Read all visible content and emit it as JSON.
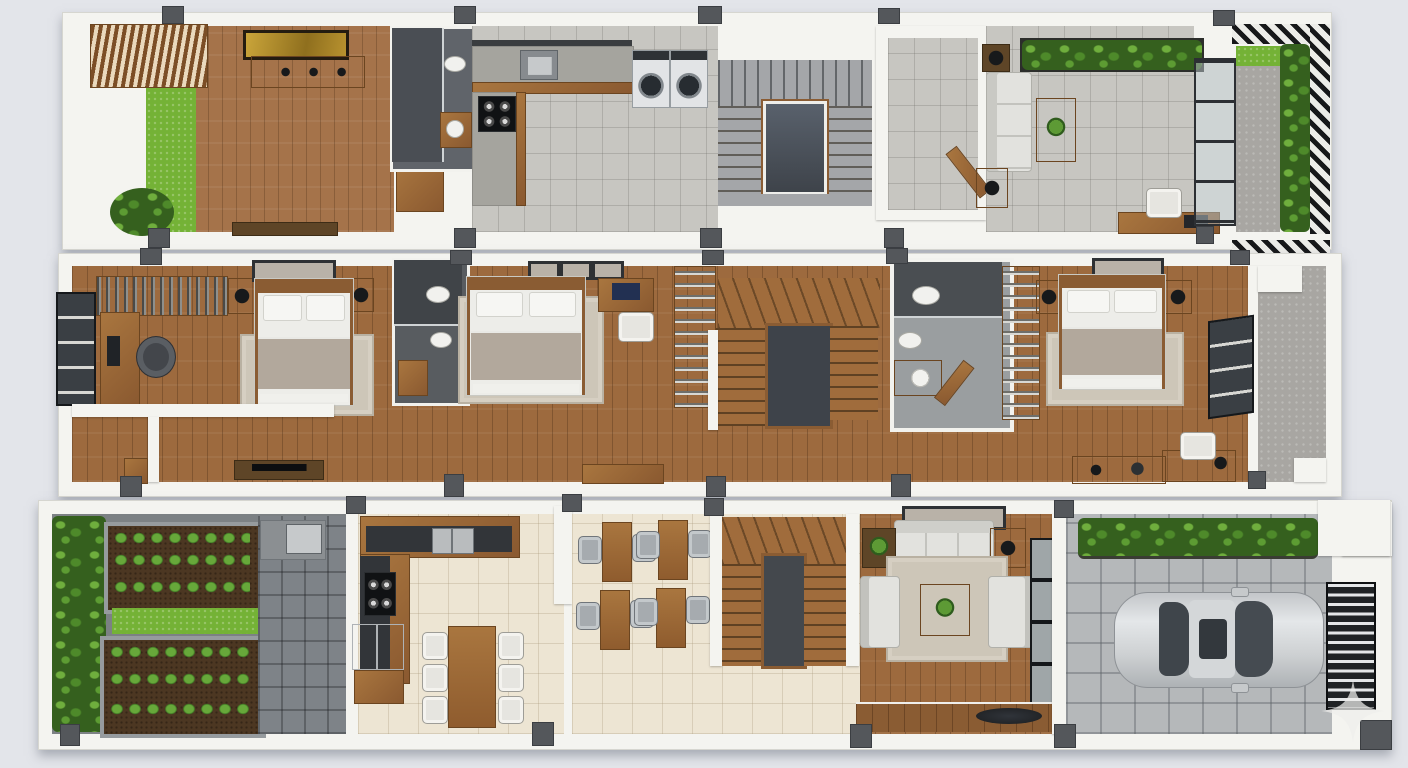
{
  "scene": {
    "title": "Three-storey narrow house floor plan — 3D top-down render",
    "view": "top-down axonometric, three floor strips stacked vertically",
    "floors": [
      {
        "name": "top floor",
        "rooms": [
          {
            "name": "family room",
            "features": [
              "slatted-pergola",
              "grass-strip",
              "potted-plant",
              "gold-wall-art",
              "console-table",
              "media-bench",
              "wood-floor"
            ]
          },
          {
            "name": "bathroom",
            "features": [
              "walk-in-shower",
              "toilet",
              "washbasin",
              "vanity"
            ]
          },
          {
            "name": "kitchen-laundry",
            "features": [
              "l-shaped-counter",
              "sink",
              "cooktop",
              "washer",
              "dryer",
              "grey-tile-floor"
            ]
          },
          {
            "name": "staircase",
            "features": [
              "u-shaped-stair",
              "open-stairwell",
              "railing"
            ]
          },
          {
            "name": "storage-room",
            "features": [
              "open-door"
            ]
          },
          {
            "name": "lounge",
            "features": [
              "sofa",
              "coffee-table",
              "side-tables",
              "planter-boxes",
              "desk",
              "chair",
              "laptop",
              "glass-sliding-doors"
            ]
          },
          {
            "name": "roof-terrace",
            "features": [
              "pergola-grating",
              "hedge",
              "grass",
              "concrete-path"
            ]
          }
        ]
      },
      {
        "name": "middle floor",
        "rooms": [
          {
            "name": "bedroom-1",
            "features": [
              "double-bed",
              "pillows",
              "rug",
              "open-wardrobe",
              "desk",
              "monitor",
              "office-chair",
              "window",
              "wall-art",
              "nightstands"
            ]
          },
          {
            "name": "ensuite-bathroom",
            "features": [
              "shower",
              "toilet",
              "bidet",
              "wood-mat"
            ]
          },
          {
            "name": "bedroom-2",
            "features": [
              "double-bed",
              "rug",
              "desk",
              "laptop",
              "chair",
              "open-shelf-wardrobe",
              "picture-frames"
            ]
          },
          {
            "name": "staircase",
            "features": [
              "wood-stair",
              "open-stairwell"
            ]
          },
          {
            "name": "bathroom-2",
            "features": [
              "shower",
              "toilet",
              "bidet",
              "vanity-sink",
              "door"
            ]
          },
          {
            "name": "wardrobe-shelf",
            "features": [
              "open-shelves"
            ]
          },
          {
            "name": "bedroom-3",
            "features": [
              "double-bed",
              "nightstands",
              "rug",
              "wall-art",
              "desk",
              "chair",
              "window"
            ]
          },
          {
            "name": "balcony",
            "features": [
              "concrete-floor",
              "white-ledges"
            ]
          },
          {
            "name": "hallway",
            "features": [
              "tv-bench",
              "cabinet",
              "dresser",
              "wood-floor"
            ]
          }
        ]
      },
      {
        "name": "ground floor",
        "rooms": [
          {
            "name": "vegetable-garden",
            "features": [
              "shrub-border",
              "raised-bed-a",
              "grass-strip",
              "raised-bed-b",
              "stone-paver-path",
              "outdoor-sink"
            ]
          },
          {
            "name": "kitchen",
            "features": [
              "l-shaped-counter",
              "sink",
              "cooktop",
              "refrigerator",
              "dining-table",
              "six-chairs",
              "beige-tile-floor"
            ]
          },
          {
            "name": "dining-area",
            "features": [
              "four-two-seat-tables",
              "eight-chairs"
            ]
          },
          {
            "name": "staircase",
            "features": [
              "wood-stair",
              "open-stairwell"
            ]
          },
          {
            "name": "living-room",
            "features": [
              "sofa",
              "two-armchairs",
              "coffee-table",
              "plant",
              "rug",
              "side-tables",
              "picture-window",
              "wood-step",
              "decor-bowl"
            ]
          },
          {
            "name": "garage-driveway",
            "features": [
              "hedge-planter",
              "silver-car",
              "slatted-gate",
              "paver-floor",
              "carport-roof"
            ]
          }
        ]
      }
    ]
  },
  "palette": {
    "background": "#e3e5ea",
    "wall_white": "#f4f4f0",
    "wood_floor": "#9d6a3e",
    "grey_tile": "#c7c6c1",
    "beige_tile": "#ede5d3",
    "dark_bathroom": "#585c60",
    "grass_green": "#74b236",
    "hedge_green": "#35601e",
    "soil_brown": "#4c3722",
    "stair_wood": "#a06c3c",
    "stair_grey": "#a4a6a9",
    "stairwell_dark": "#3e434a",
    "car_silver": "#ced1d3",
    "column_grey": "#54575b",
    "gold_art": "#b8922f",
    "rug_beige": "#cdc6b8"
  },
  "watermark": {
    "shape": "four-point-star",
    "color": "rgba(238,238,236,0.85)"
  }
}
